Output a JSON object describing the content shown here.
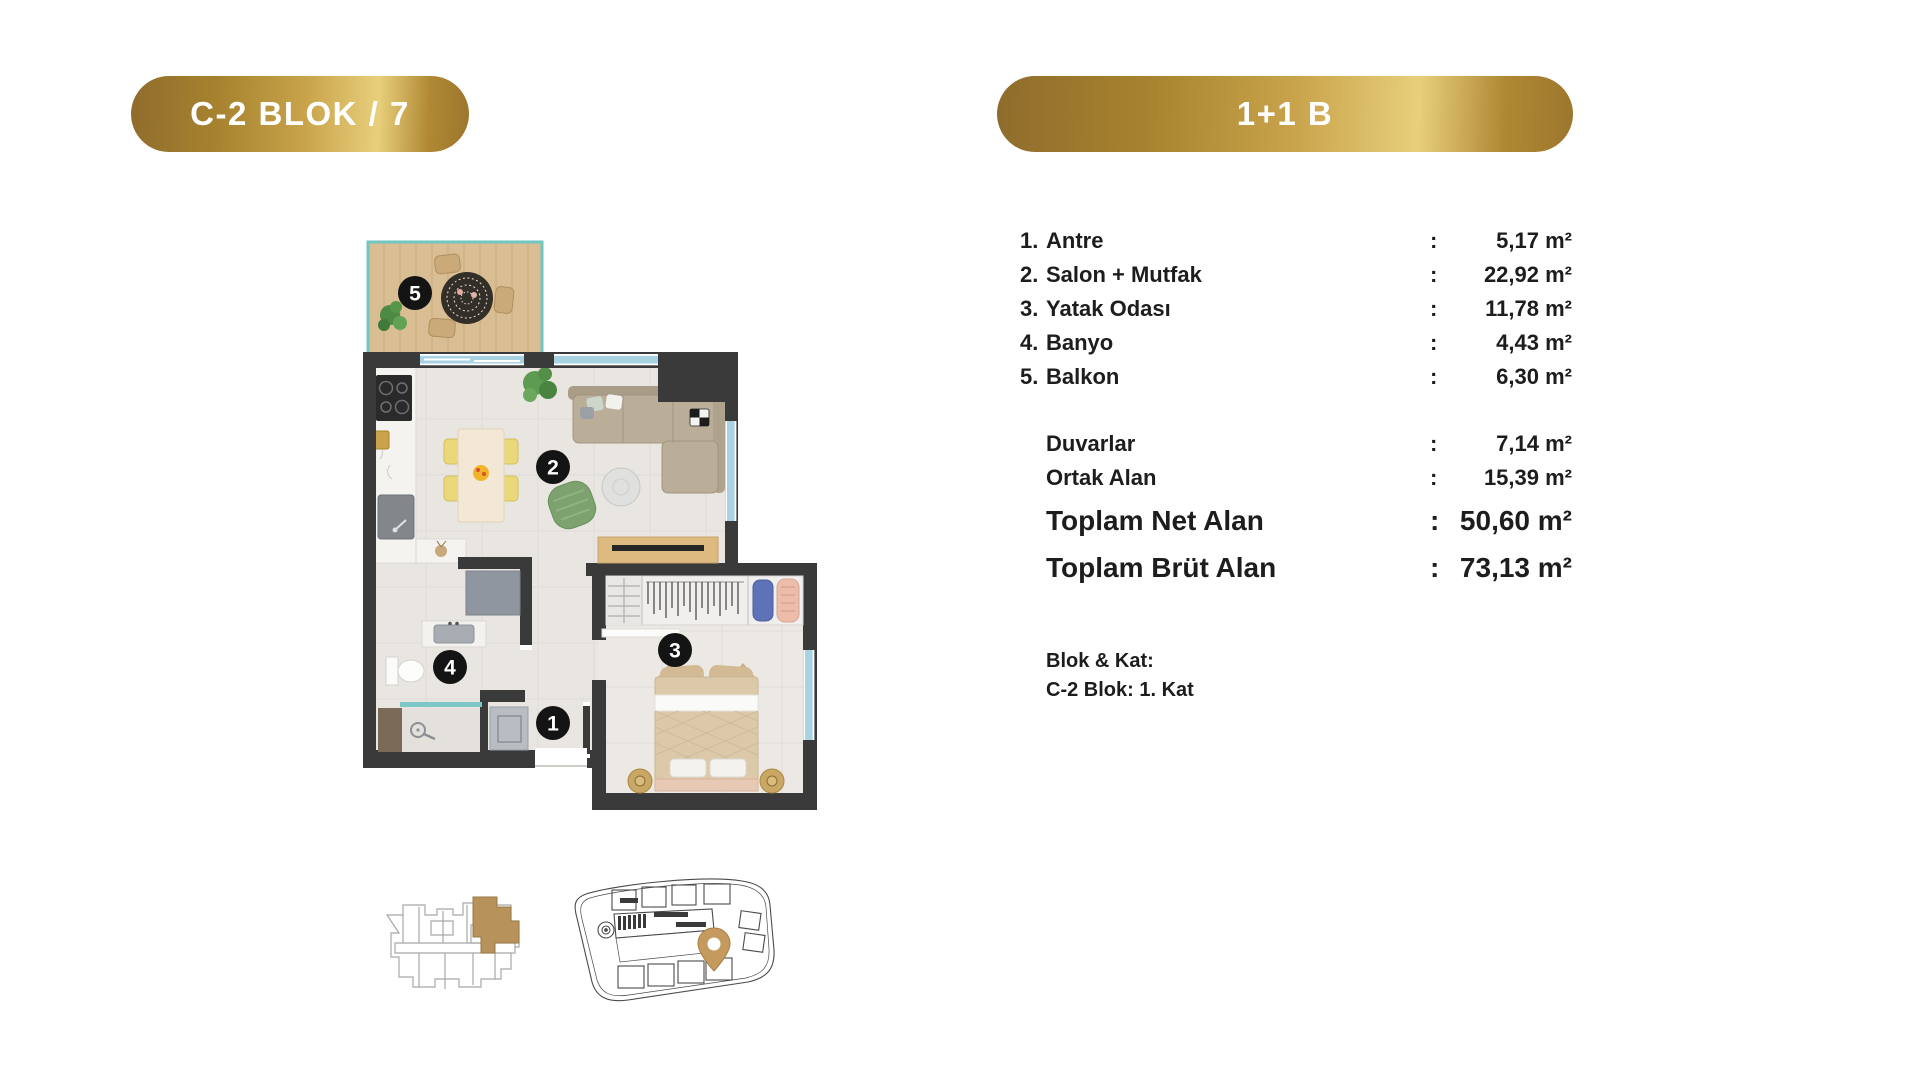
{
  "badges": {
    "left": "C-2 BLOK / 7",
    "right": "1+1 B"
  },
  "plan": {
    "numbers": [
      "1",
      "2",
      "3",
      "4",
      "5"
    ]
  },
  "details": {
    "rooms": [
      {
        "num": "1.",
        "label": "Antre",
        "colon": ":",
        "value": "5,17 m²"
      },
      {
        "num": "2.",
        "label": "Salon + Mutfak",
        "colon": ":",
        "value": "22,92 m²"
      },
      {
        "num": "3.",
        "label": "Yatak Odası",
        "colon": ":",
        "value": "11,78 m²"
      },
      {
        "num": "4.",
        "label": "Banyo",
        "colon": ":",
        "value": "4,43 m²"
      },
      {
        "num": "5.",
        "label": "Balkon",
        "colon": ":",
        "value": "6,30 m²"
      }
    ],
    "extras": [
      {
        "label": "Duvarlar",
        "colon": ":",
        "value": "7,14 m²"
      },
      {
        "label": "Ortak Alan",
        "colon": ":",
        "value": "15,39 m²"
      }
    ],
    "totals": [
      {
        "label": "Toplam Net Alan",
        "colon": ":",
        "value": "50,60 m²"
      },
      {
        "label": "Toplam Brüt Alan",
        "colon": ":",
        "value": "73,13 m²"
      }
    ],
    "block": {
      "title": "Blok & Kat:",
      "line": "C-2 Blok: 1. Kat"
    }
  },
  "colors": {
    "gold_dark": "#8f6c2c",
    "gold_light": "#e8cf7b",
    "wall": "#3a3a3a",
    "window_blue": "#a9d2e3",
    "railing_teal": "#72c6c2",
    "highlight_tan": "#b7925a"
  }
}
